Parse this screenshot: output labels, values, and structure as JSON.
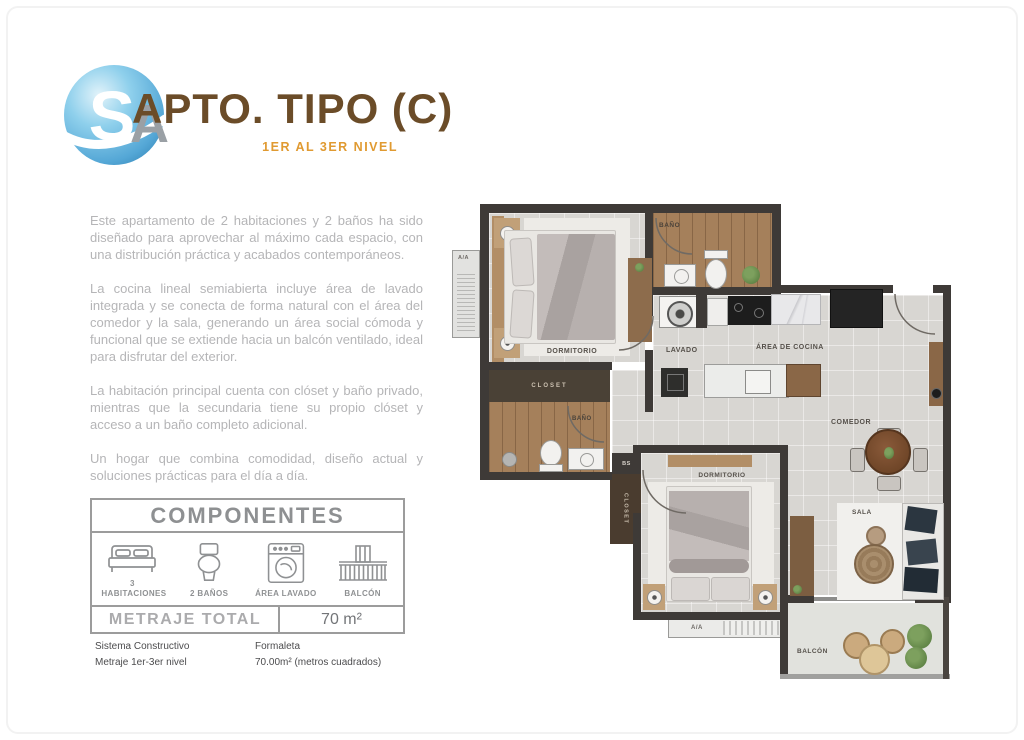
{
  "header": {
    "logo_letter": "S",
    "logo_monogram_letter": "A",
    "title": "APTO. TIPO (C)",
    "subtitle": "1ER AL 3ER NIVEL"
  },
  "description": {
    "paragraphs": [
      "Este apartamento de 2 habitaciones y 2 baños ha sido diseñado para aprovechar al máximo cada espacio, con una distribución práctica y acabados contemporáneos.",
      "La cocina lineal semiabierta incluye área de lavado integrada y se conecta de forma natural con el área del comedor y la sala, generando un área social cómoda y funcional que se extiende hacia un balcón ventilado, ideal para disfrutar del exterior.",
      "La habitación principal cuenta con clóset y baño privado, mientras que la secundaria tiene su propio clóset y acceso a un baño completo adicional.",
      "Un hogar que combina comodidad, diseño actual y soluciones prácticas para el día a día."
    ]
  },
  "components": {
    "title": "COMPONENTES",
    "items": [
      {
        "icon": "bed-icon",
        "label": "3 HABITACIONES"
      },
      {
        "icon": "toilet-icon",
        "label": "2 BAÑOS"
      },
      {
        "icon": "washer-icon",
        "label": "ÁREA LAVADO"
      },
      {
        "icon": "balcony-icon",
        "label": "BALCÓN"
      }
    ],
    "metraje_label": "METRAJE TOTAL",
    "metraje_value": "70 m²"
  },
  "specs": [
    {
      "label": "Sistema Constructivo",
      "value": "Formaleta"
    },
    {
      "label": "Metraje 1er-3er nivel",
      "value": "70.00m² (metros cuadrados)"
    }
  ],
  "floorplan": {
    "labels": {
      "dormitorio_principal": "DORMITORIO",
      "bano_principal": "BAÑO",
      "closet_principal": "CLOSET",
      "bano_secundario": "BAÑO",
      "closet_secundario": "CLOSET",
      "bs": "BS",
      "lavado": "LAVADO",
      "area_cocina": "ÁREA DE COCINA",
      "comedor": "COMEDOR",
      "dormitorio_secundario": "DORMITORIO",
      "sala": "SALA",
      "aa_left": "A/A",
      "aa_bottom": "A/A",
      "balcon": "BALCÓN"
    },
    "colors": {
      "wall": "#3e3a37",
      "wood_floor": "#a5805b",
      "tile_floor": "#d8d6d2",
      "closet_dark": "#4a3c2f",
      "logo_blue": "#5fb0dc",
      "title_brown": "#6b4c28",
      "subtitle_orange": "#e09a31"
    }
  }
}
